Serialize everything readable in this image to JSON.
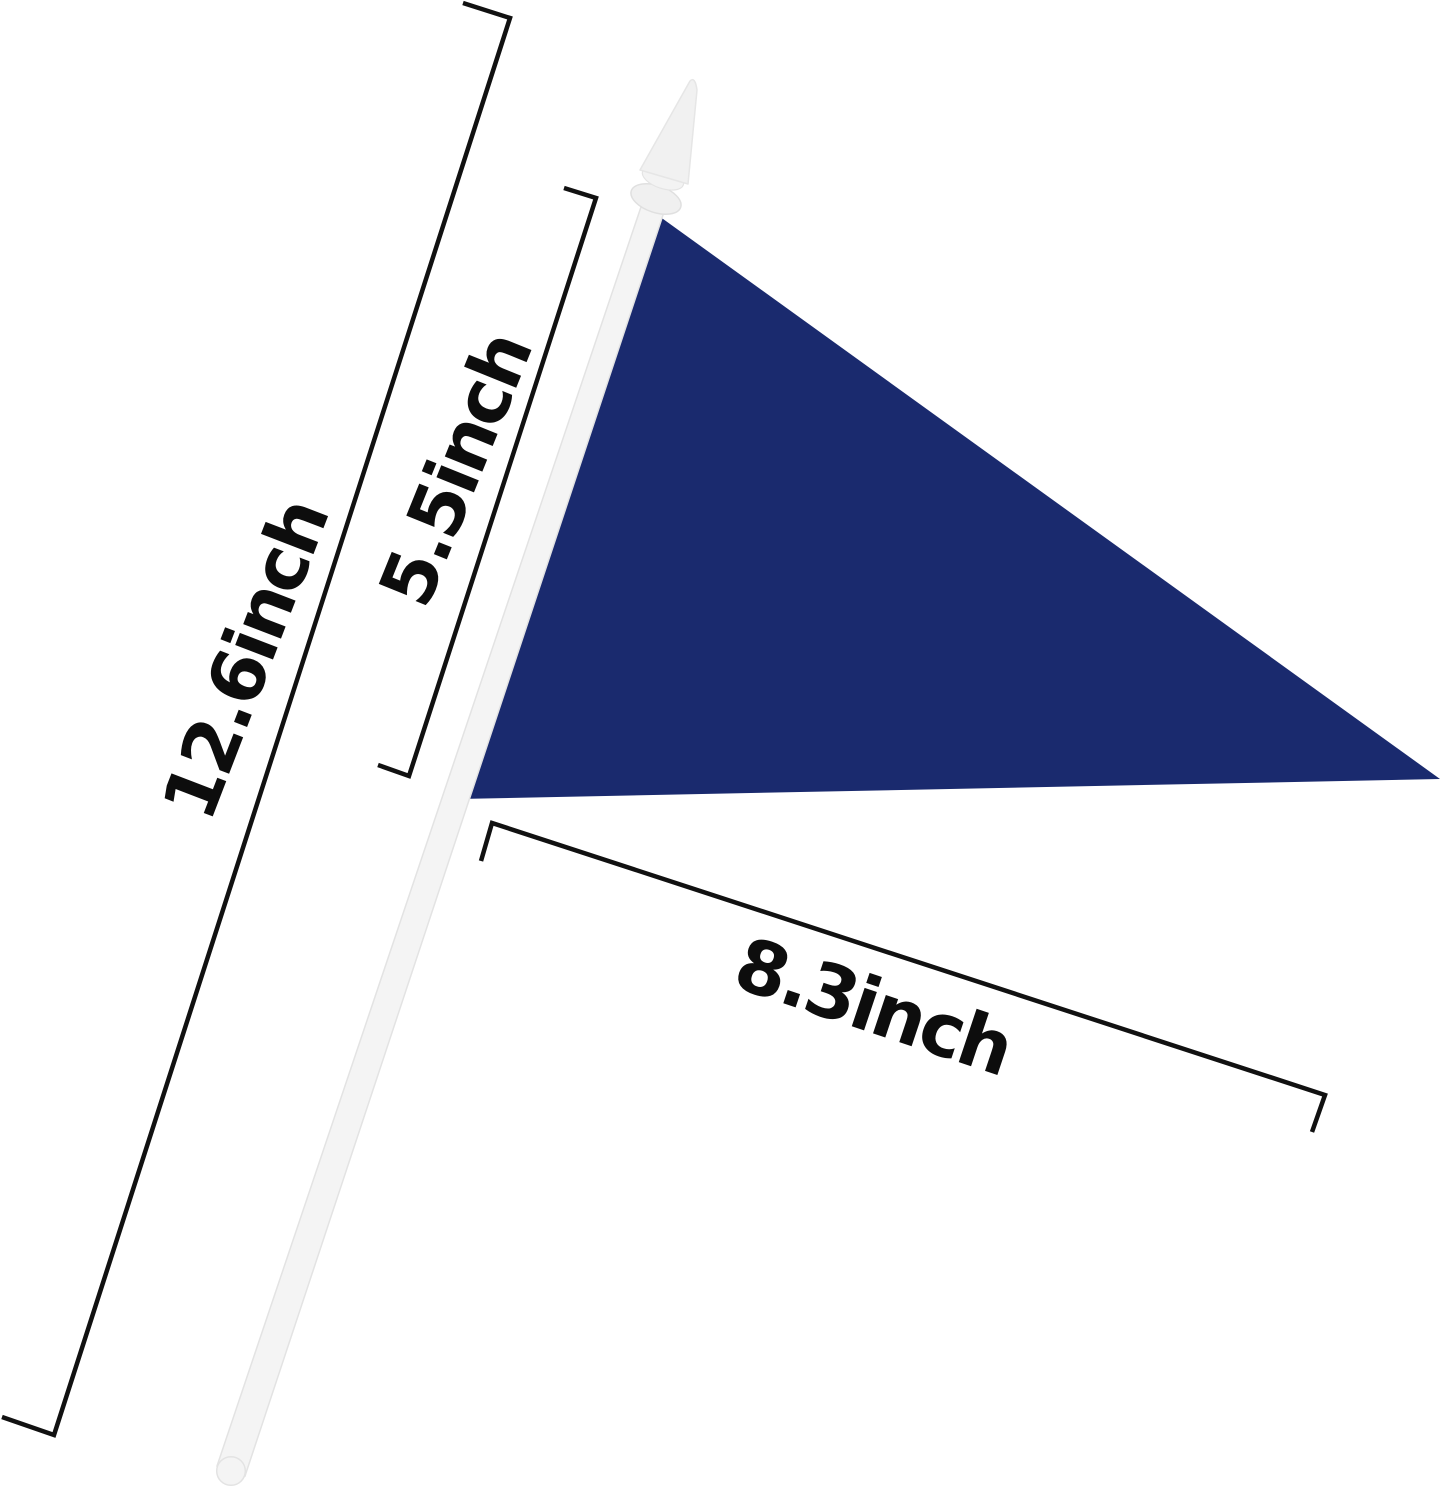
{
  "figure": {
    "labels": {
      "pole_length": "12.6inch",
      "flag_hoist_side": "5.5inch",
      "flag_length": "8.3inch"
    },
    "colors": {
      "flag_navy": "#1a2a6e",
      "dimension_line": "#111111",
      "label_text": "#0d0d0d",
      "pole_fill": "#f4f4f4",
      "pole_edge": "#e3e3e3",
      "finial_fill": "#f1f1f1",
      "background": "#ffffff"
    }
  }
}
